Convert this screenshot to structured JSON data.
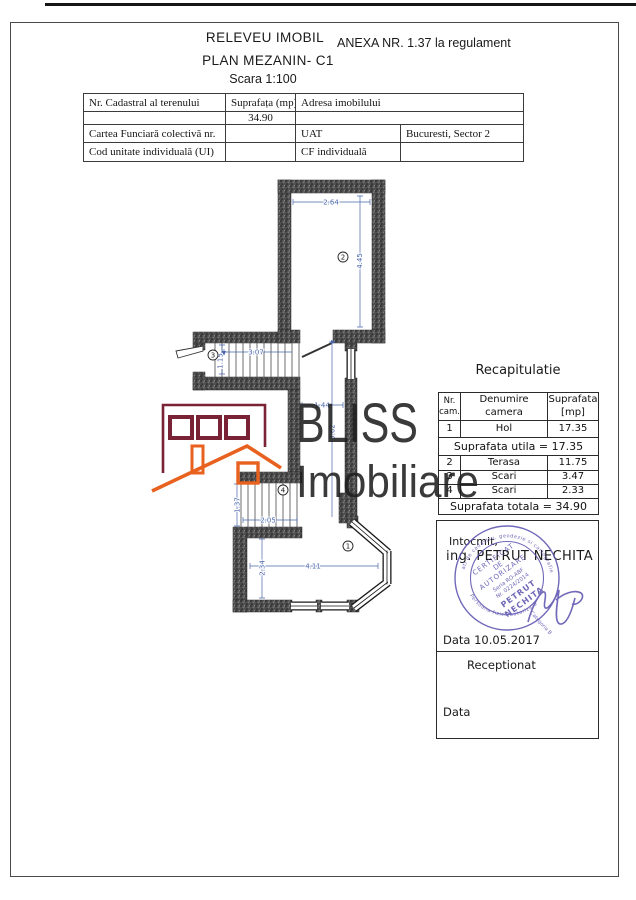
{
  "header": {
    "title": "RELEVEU IMOBIL",
    "annex": "ANEXA NR. 1.37 la regulament",
    "subtitle": "PLAN  MEZANIN- C1",
    "scale": "Scara 1:100"
  },
  "info_table": {
    "col1_header": "Nr. Cadastral al terenului",
    "col2_header": "Suprafața (mp)",
    "col3_header": "Adresa imobilului",
    "area_value": "34.90",
    "row3_label": "Cartea Funciară colectivă nr.",
    "row3_mid": "UAT",
    "row3_value": "Bucuresti, Sector 2",
    "row4_label": "Cod unitate individuală (UI)",
    "row4_mid": "CF individuală"
  },
  "plan": {
    "dims": {
      "room2_width": "2.64",
      "room2_height": "4.45",
      "stairs3_width": "3.07",
      "stairs3_height": "1.15",
      "corridor_width": "1.44",
      "corridor_height": "3.62",
      "stairs4_width": "2.05",
      "stairs4_height": "1.37",
      "room1_width": "4.11",
      "room1_height": "2.34"
    },
    "room_numbers": {
      "r1": "1",
      "r2": "2",
      "r3": "3",
      "r4": "4"
    },
    "dimension_color": "#4a66ae"
  },
  "watermark": {
    "brand": "BLISS",
    "brand2": "Imobiliare",
    "maroon": "#7b2336",
    "orange": "#e8611f"
  },
  "recap": {
    "title": "Recapitulatie",
    "headers": [
      "Nr. cam.",
      "Denumire camera",
      "Suprafata [mp]"
    ],
    "rows": [
      [
        "1",
        "Hol",
        "17.35"
      ],
      [
        "2",
        "Terasa",
        "11.75"
      ],
      [
        "3",
        "Scari",
        "3.47"
      ],
      [
        "4",
        "Scari",
        "2.33"
      ]
    ],
    "subtotal": "Suprafata utila = 17.35",
    "total": "Suprafata totala = 34.90"
  },
  "signature": {
    "prepared_label": "Intocmit,",
    "prepared_name": "ing. PETRUT NECHITA",
    "date": "Data 10.05.2017",
    "received_label": "Receptionat",
    "date_label": "Data",
    "stamp": {
      "color": "#5b52ae",
      "rim_top": "ati de cadastru, geodezie si cartografie",
      "rim_bottom": "Persoana fizica autorizata",
      "line1": "CERTIFICAT",
      "line2": "DE",
      "line3": "AUTORIZARE",
      "serial": "Seria RO-ABF",
      "number": "Nr. 0224/2014",
      "name1": "PETRUT",
      "name2": "NECHITA",
      "category": "Categoria B"
    }
  }
}
